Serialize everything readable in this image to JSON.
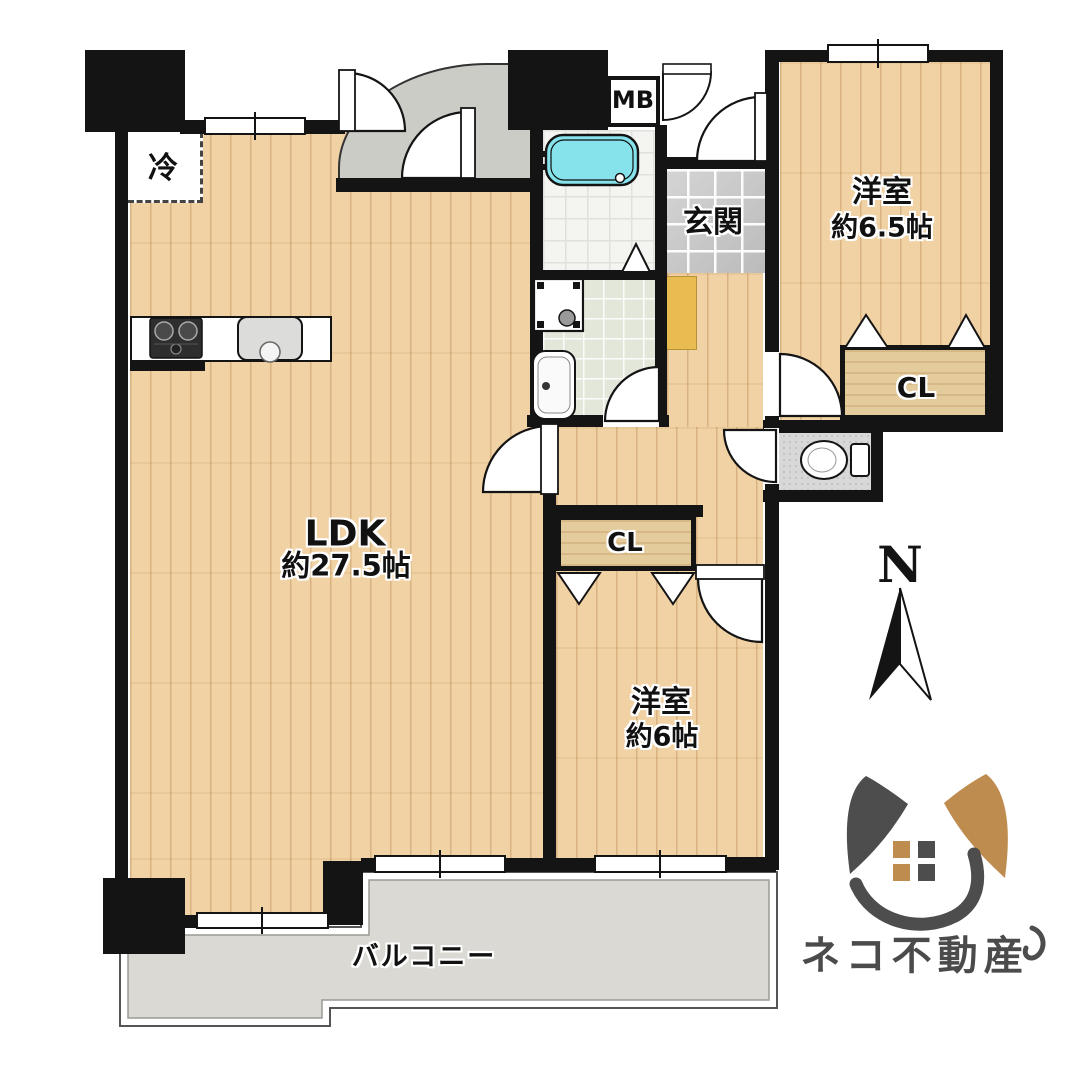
{
  "rooms": {
    "ldk": {
      "name": "LDK",
      "size": "約27.5帖"
    },
    "bedroom1": {
      "name": "洋室",
      "size": "約6.5帖"
    },
    "bedroom2": {
      "name": "洋室",
      "size": "約6帖"
    },
    "genkan": {
      "label": "玄関"
    },
    "balcony": {
      "label": "バルコニー"
    },
    "closet1": {
      "label": "CL"
    },
    "closet2": {
      "label": "CL"
    },
    "refrigerator": {
      "label": "冷"
    },
    "meter_box": {
      "label": "MB"
    }
  },
  "compass": {
    "label": "N"
  },
  "logo": {
    "company": "ネコ不動産"
  },
  "colors": {
    "wall": "#141414",
    "wood_floor": "#f1d2a4",
    "bathtub": "#86e3ec",
    "balcony_floor": "#dad9d3",
    "closet_floor": "#e4cb9c",
    "shoe_cabinet": "#e9bc52",
    "logo_dark": "#4b4b4b",
    "logo_tan": "#bf8c4f"
  }
}
